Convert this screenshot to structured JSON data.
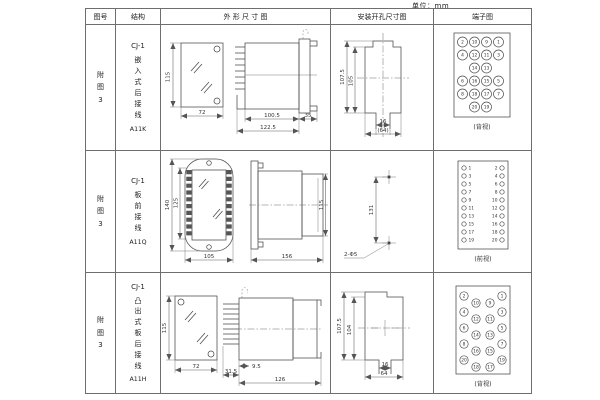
{
  "unit_label": "单位：mm",
  "header": {
    "figure_no": "图号",
    "structure": "结构",
    "outline": "外 形 尺 寸 图",
    "mounting": "安装开孔尺寸图",
    "terminal": "端子图"
  },
  "rows": [
    {
      "figure_no": "附\n图\n3",
      "model": "CJ-1",
      "structure_type": "嵌\n入\n式\n后\n接\n线",
      "code": "A11K",
      "outline": {
        "front_h": "115",
        "front_w": "72",
        "len_body": "100.5",
        "len_total": "122.5",
        "flange": "35"
      },
      "mounting": {
        "h_outer": "107.5",
        "h_inner": "105",
        "slot_w": "16",
        "w_total": "(64)"
      },
      "terminal": {
        "view": "(背视)",
        "grid": [
          [
            "2",
            "10",
            "9",
            "1"
          ],
          [
            "4",
            "12",
            "11",
            "3"
          ],
          [
            "14",
            "13"
          ],
          [
            "6",
            "16",
            "15",
            "5"
          ],
          [
            "8",
            "18",
            "17",
            "7"
          ],
          [
            "20",
            "19"
          ]
        ]
      }
    },
    {
      "figure_no": "附\n图\n3",
      "model": "CJ-1",
      "structure_type": "板\n前\n接\n线",
      "code": "A11Q",
      "outline": {
        "front_h": "140",
        "front_inner": "125",
        "front_w": "105",
        "len_total": "156",
        "side_h": "115"
      },
      "mounting": {
        "hole_span": "131",
        "hole_label": "2-Φ5"
      },
      "terminal": {
        "view": "(前视)",
        "left": [
          "1",
          "3",
          "5",
          "7",
          "9",
          "11",
          "13",
          "15",
          "17",
          "19"
        ],
        "right": [
          "2",
          "4",
          "6",
          "8",
          "10",
          "12",
          "14",
          "16",
          "18",
          "20"
        ]
      }
    },
    {
      "figure_no": "附\n图\n3",
      "model": "CJ-1",
      "structure_type": "凸\n出\n式\n板\n后\n接\n线",
      "code": "A11H",
      "outline": {
        "front_h": "115",
        "front_w": "72",
        "d1": "9.5",
        "d2": "31.5",
        "len_total": "126"
      },
      "mounting": {
        "h_outer": "107.5",
        "h_inner": "104",
        "slot_w": "16",
        "w_total": "64"
      },
      "terminal": {
        "view": "(背视)",
        "outer_left": [
          "2",
          "4",
          "6",
          "8",
          "20"
        ],
        "inner_left": [
          "10",
          "12",
          "14",
          "16",
          "18"
        ],
        "inner_right": [
          "9",
          "11",
          "13",
          "15",
          "17"
        ],
        "outer_right": [
          "1",
          "3",
          "5",
          "7",
          "19"
        ]
      }
    }
  ]
}
